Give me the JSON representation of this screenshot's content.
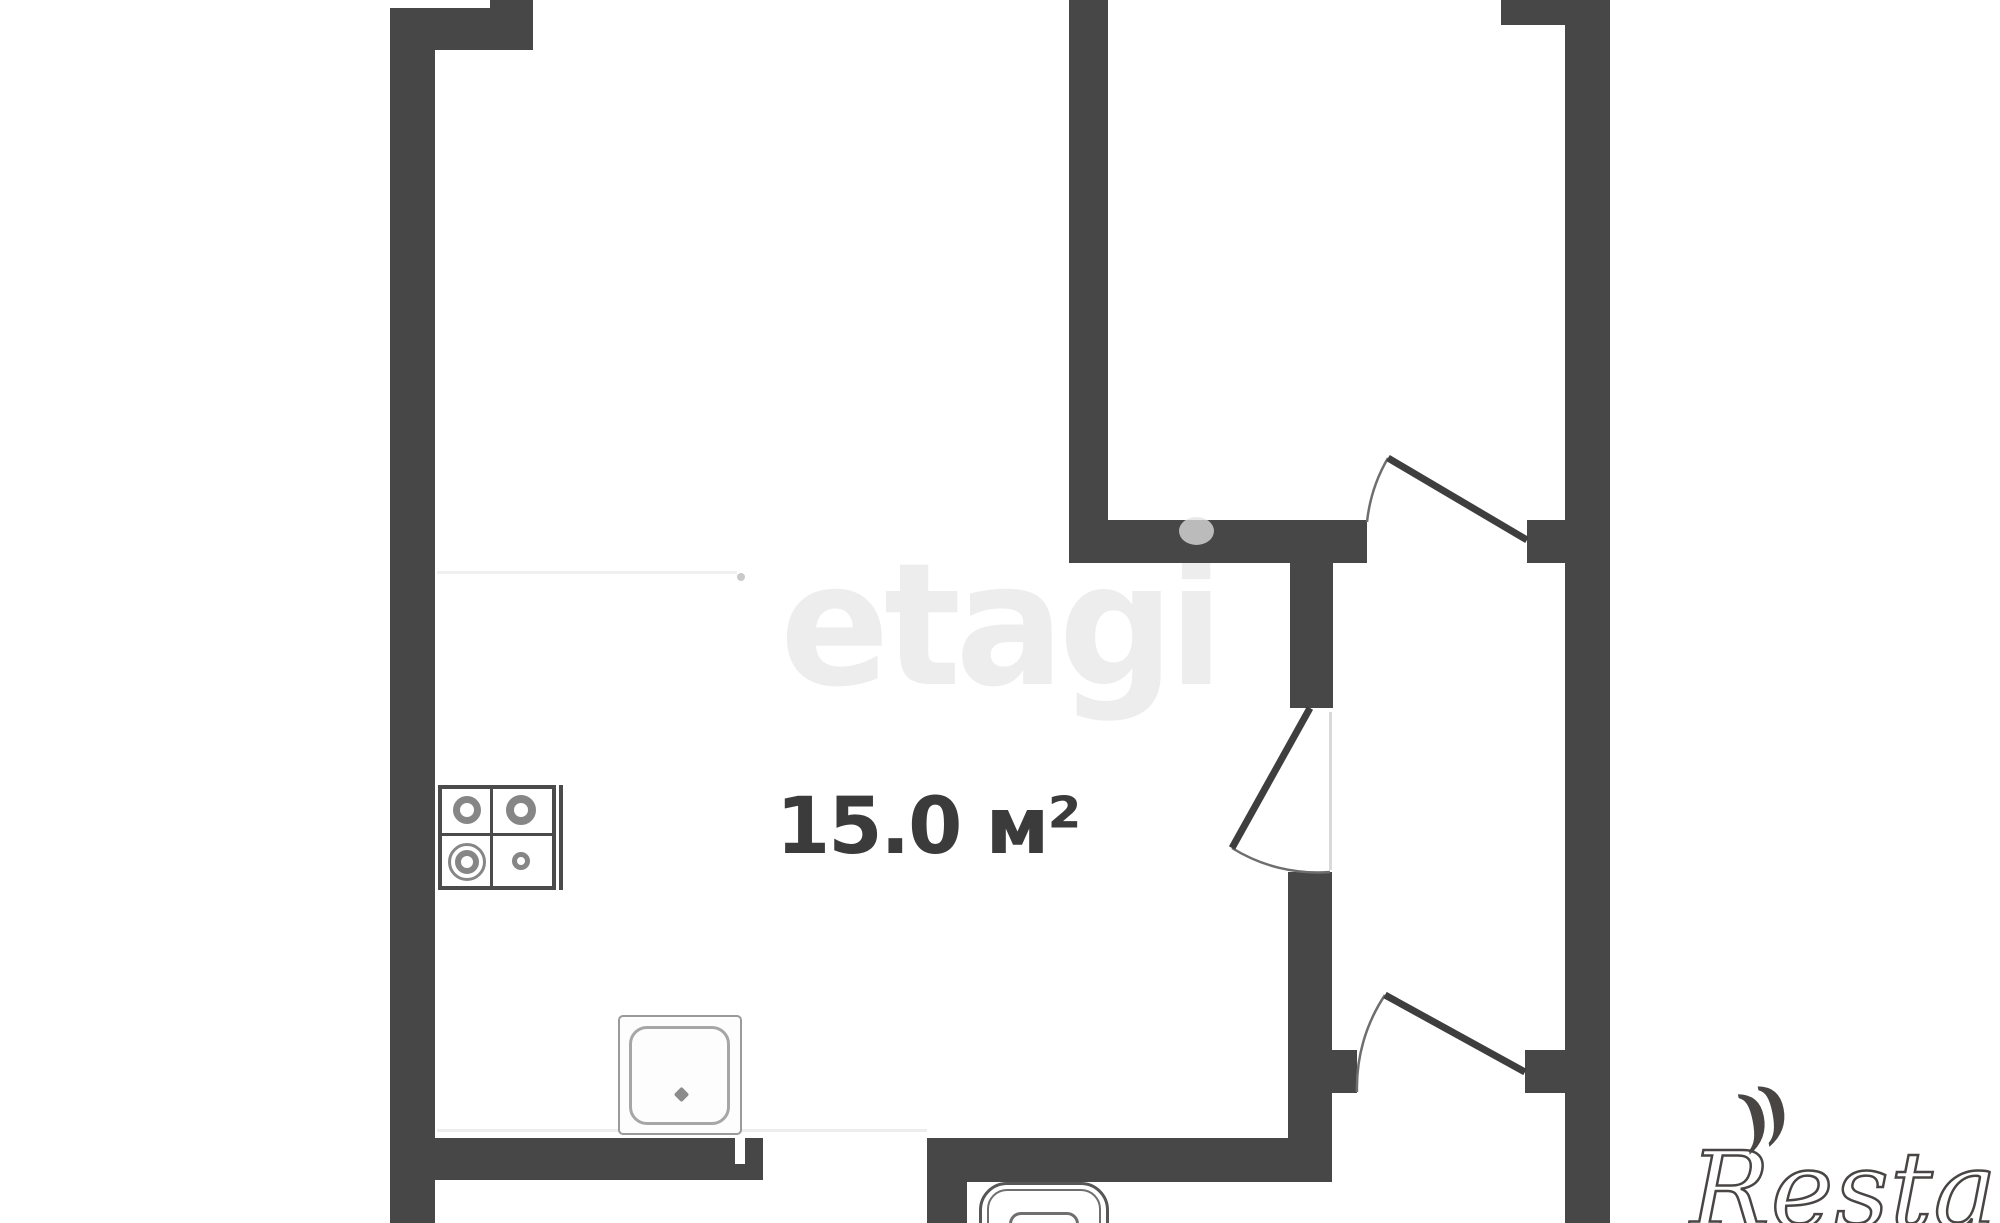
{
  "canvas": {
    "width": 2000,
    "height": 1223,
    "background": "#ffffff"
  },
  "room": {
    "label": "15.0 м²",
    "area_value": "15.0",
    "area_unit": "м²"
  },
  "watermarks": {
    "center": {
      "text": "etagi",
      "color": "#ededed"
    },
    "bottom_right": {
      "text": "Restate",
      "mark": "))",
      "color": "#4a4545"
    }
  },
  "icons": [
    "stove-icon",
    "sink-icon",
    "toilet-icon",
    "door-swing-arc",
    "door-leaf"
  ],
  "floorplan": {
    "wall_color": "#474747",
    "walls": [
      {
        "x": 390,
        "y": 8,
        "w": 45,
        "h": 1215
      },
      {
        "x": 390,
        "y": 8,
        "w": 143,
        "h": 42
      },
      {
        "x": 490,
        "y": 0,
        "w": 43,
        "h": 50
      },
      {
        "x": 1069,
        "y": 0,
        "w": 39,
        "h": 563
      },
      {
        "x": 1069,
        "y": 520,
        "w": 298,
        "h": 43
      },
      {
        "x": 1290,
        "y": 563,
        "w": 43,
        "h": 145
      },
      {
        "x": 1288,
        "y": 872,
        "w": 44,
        "h": 268
      },
      {
        "x": 390,
        "y": 1138,
        "w": 373,
        "h": 42
      },
      {
        "x": 927,
        "y": 1138,
        "w": 405,
        "h": 44
      },
      {
        "x": 927,
        "y": 1182,
        "w": 40,
        "h": 41
      },
      {
        "x": 1565,
        "y": 0,
        "w": 45,
        "h": 1223
      },
      {
        "x": 1501,
        "y": 0,
        "w": 64,
        "h": 25
      },
      {
        "x": 1527,
        "y": 520,
        "w": 43,
        "h": 43
      },
      {
        "x": 1330,
        "y": 1050,
        "w": 27,
        "h": 43
      },
      {
        "x": 1525,
        "y": 1050,
        "w": 45,
        "h": 43
      }
    ],
    "white_notches": [
      {
        "x": 735,
        "y": 1138,
        "w": 10,
        "h": 26,
        "color": "#ffffff"
      }
    ],
    "faint_lines": [
      {
        "x": 437,
        "y": 571,
        "w": 300,
        "h": 3,
        "color": "#f0f0f0"
      },
      {
        "x": 437,
        "y": 1129,
        "w": 490,
        "h": 3,
        "color": "#ededed"
      },
      {
        "x": 1329,
        "y": 712,
        "w": 3,
        "h": 158,
        "color": "#d9d9d9"
      }
    ],
    "overlay_blobs": [
      {
        "x": 1179,
        "y": 517,
        "w": 35,
        "h": 28,
        "color": "rgba(225,225,225,0.75)"
      },
      {
        "x": 737,
        "y": 573,
        "w": 8,
        "h": 8,
        "color": "#c9c9c9"
      }
    ],
    "doors": [
      {
        "leaf": "M1527 540 L1388 458",
        "arc": "M1367 522 A160 160 0 0 1 1388 458"
      },
      {
        "leaf": "M1310 708 L1232 848",
        "arc": "M1232 848 A162 162 0 0 0 1330 872"
      },
      {
        "leaf": "M1525 1072 L1385 995",
        "arc": "M1357 1092 A166 166 0 0 1 1385 995"
      }
    ]
  }
}
